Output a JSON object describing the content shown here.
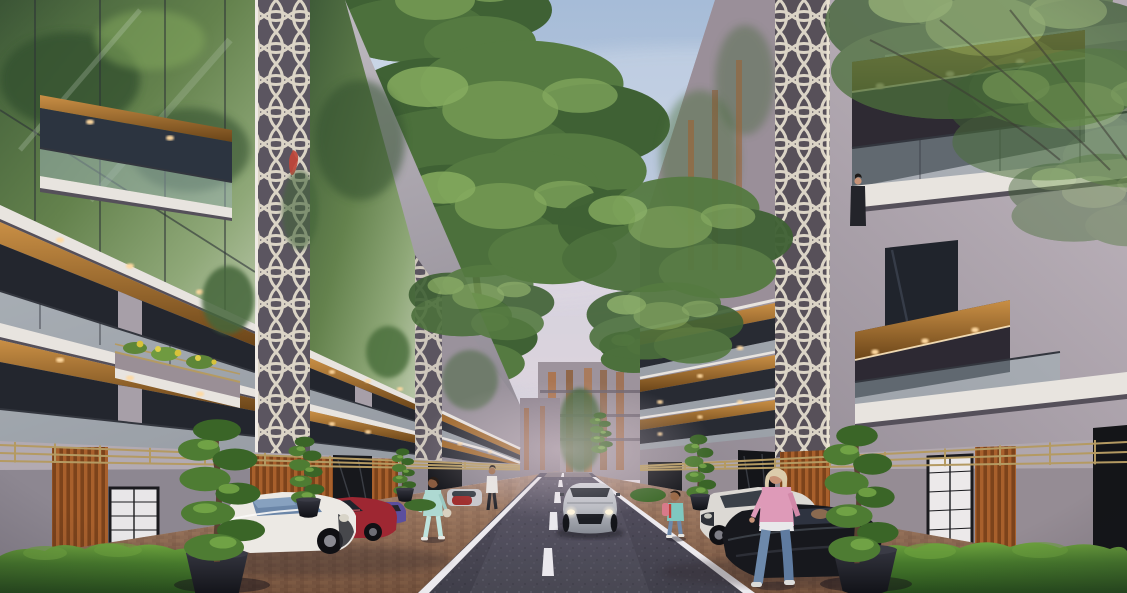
{
  "scene_type": "architectural-street-rendering-dusk",
  "palette": {
    "sky_top": "#a6bcd8",
    "sky_mid": "#c6cfdf",
    "sky_horizon": "#e3d8de",
    "cloud": "#eef2f7",
    "haze_pink": "#e9d6de",
    "concrete_light": "#c9c5cb",
    "concrete_mid": "#a79fa8",
    "concrete_dark": "#8d8791",
    "concrete_right_light": "#c4bac2",
    "concrete_right_dark": "#8f8791",
    "slab_white": "#e8e4df",
    "slab_shadow": "#55505a",
    "wood_light": "#c98f45",
    "wood_mid": "#a06a2e",
    "wood_dark": "#6b4519",
    "lattice_cream_left": "#dfd9d2",
    "lattice_cream_right": "#d8cdb8",
    "glass_green_dark": "#3f5c38",
    "glass_green_light": "#8fa878",
    "rail_glass": "#9fb6ba",
    "rail_dark": "#33363e",
    "interior_dark": "#23262e",
    "brass": "#b49a62",
    "road_near": "#403f4a",
    "road_far": "#575263",
    "road_line": "#eceaee",
    "paver_light": "#a07a5c",
    "paver_dark": "#6b4c38",
    "paver_far": "#c3aaa2",
    "hedge_light": "#6da23e",
    "hedge_mid": "#477a2c",
    "hedge_dark": "#274e1c",
    "topiary_light": "#79ab4a",
    "topiary_dark": "#3a6527",
    "pot_black": "#1c1d23",
    "trunk_brown": "#5a4332",
    "car_silver": "#b7bac1",
    "car_white": "#ece9e4",
    "car_red": "#9e2732",
    "car_purple": "#5b4f9e",
    "car_black": "#17181d",
    "car_white_right": "#dcd9d4",
    "headlight": "#fff6dd",
    "warm_light": "#ffd9a0",
    "skin": "#c79377",
    "denim": "#6d89ab",
    "teal_outfit": "#aed9d2",
    "pink_top": "#de9ab8",
    "hair_blonde": "#dcccab",
    "suit_dark": "#23242a"
  },
  "inventory": {
    "buildings": [
      "left-apartment-row",
      "right-apartment-row",
      "distant-buildings"
    ],
    "vehicles": [
      {
        "name": "silver-sports-car-driving",
        "color": "#b7bac1"
      },
      {
        "name": "white-mini-parked-left",
        "color": "#ece9e4"
      },
      {
        "name": "red-hatchback-parked-left",
        "color": "#9e2732"
      },
      {
        "name": "purple-car-parked-left",
        "color": "#5b4f9e"
      },
      {
        "name": "distant-silver-car-left",
        "color": "#c8c8cc"
      },
      {
        "name": "white-hatchback-parked-right",
        "color": "#dcd9d4"
      },
      {
        "name": "black-sedan-parked-right",
        "color": "#17181d"
      }
    ],
    "people": [
      {
        "name": "woman-teal-outfit-left-sidewalk"
      },
      {
        "name": "pedestrian-white-shirt-left"
      },
      {
        "name": "child-backpack-right-sidewalk"
      },
      {
        "name": "woman-pink-top-right-sidewalk"
      },
      {
        "name": "man-on-right-balcony"
      },
      {
        "name": "person-red-on-left-balcony"
      }
    ],
    "vegetation": [
      "spiral-topiary-left",
      "spiral-topiary-right",
      "hedges",
      "street-trees",
      "balcony-plants"
    ],
    "street": [
      "asphalt-road",
      "dashed-center-line",
      "edge-lines",
      "brick-pavement"
    ]
  },
  "lighting": {
    "time_of_day": "dusk",
    "balcony_downlights": "#ffd9a0",
    "headlights": "#fff6dd"
  }
}
